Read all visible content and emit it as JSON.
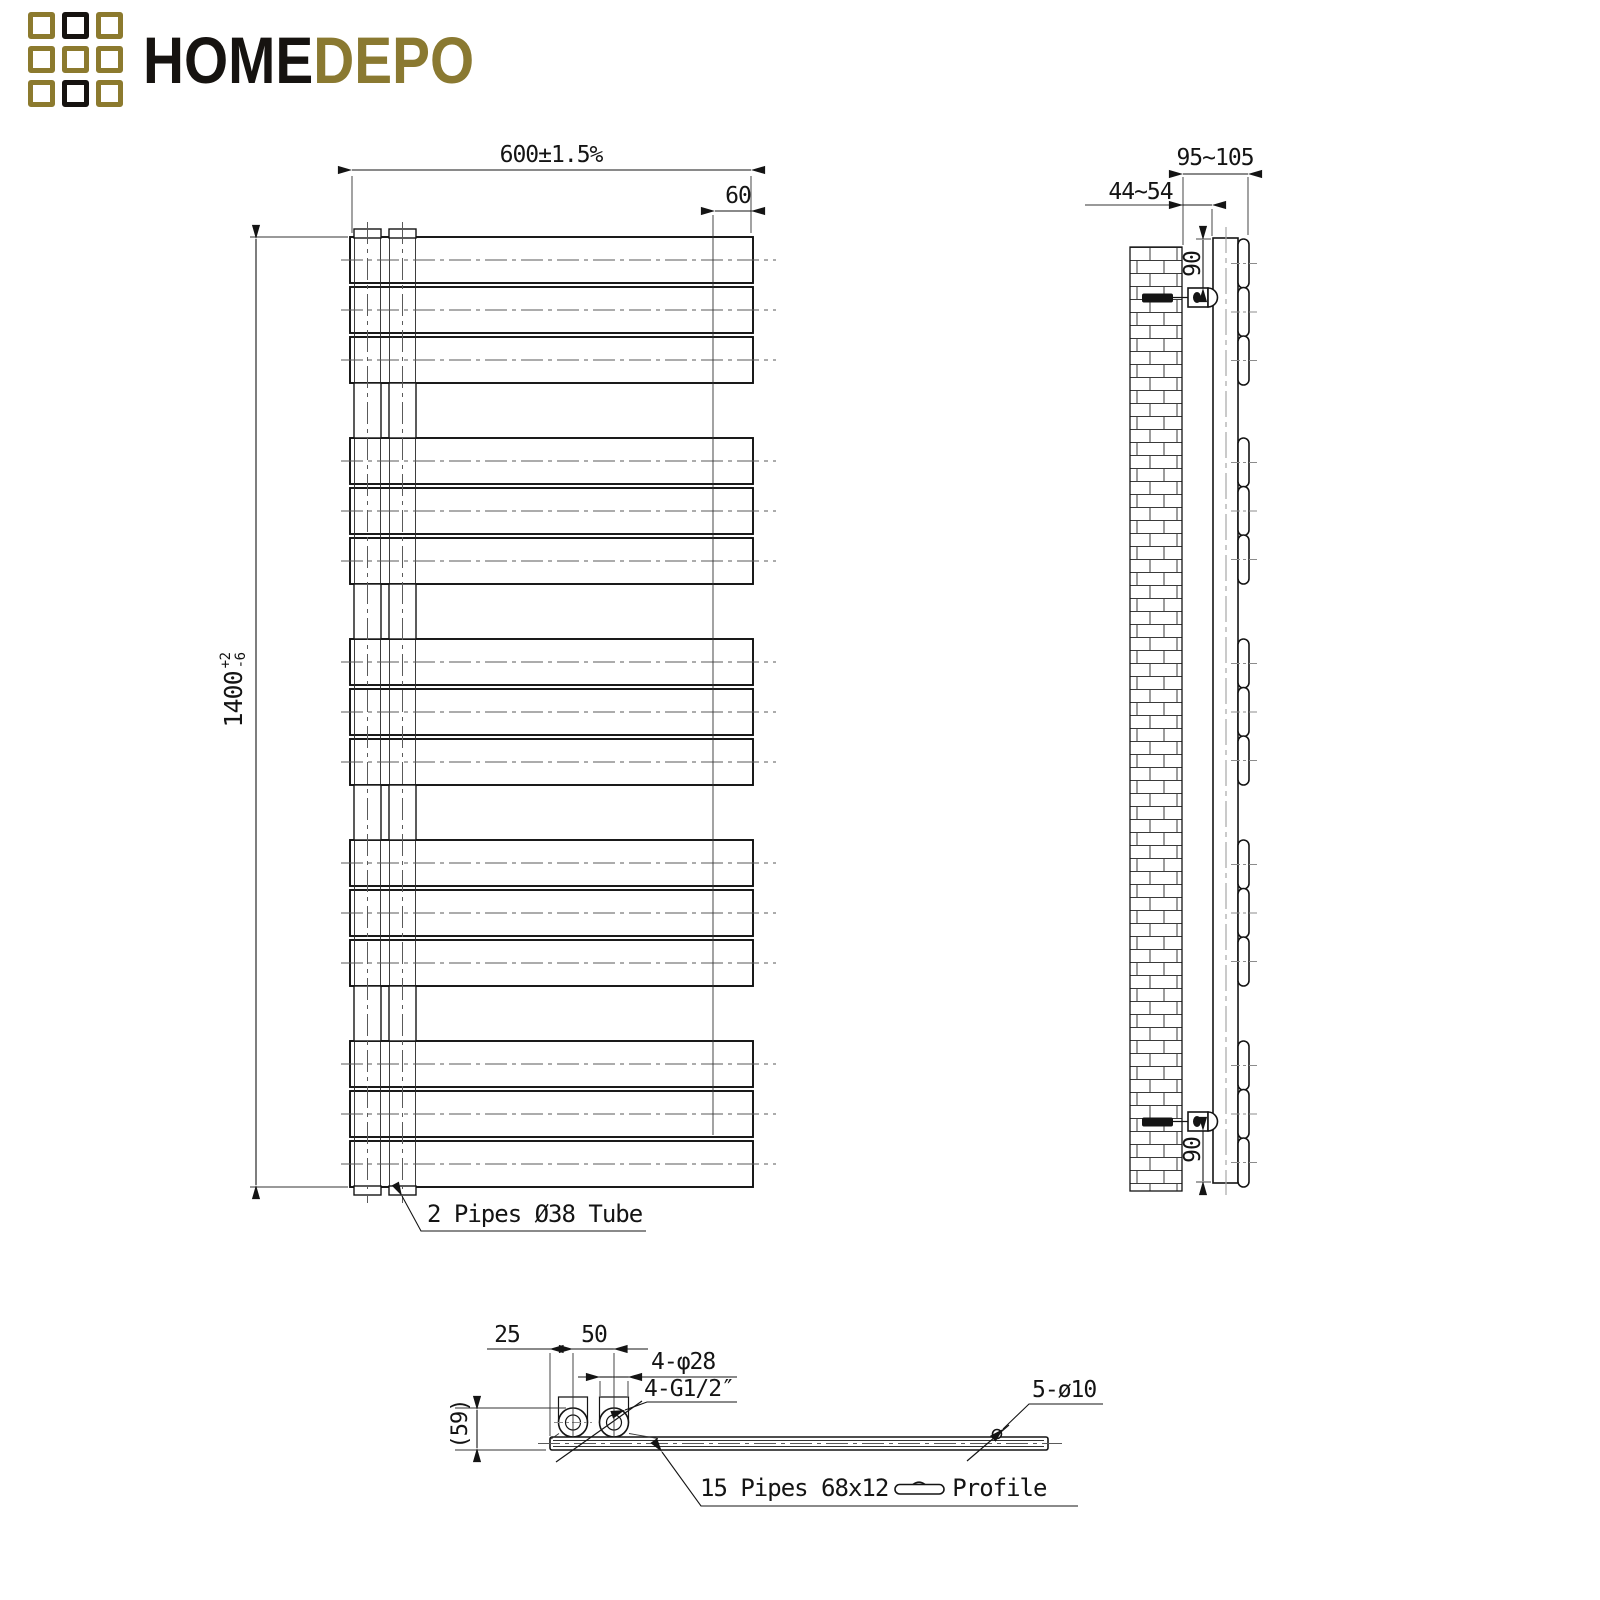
{
  "logo": {
    "brand_black": "HOME",
    "brand_gold": "DEPO",
    "colors": {
      "gold": "#8c7a2e",
      "black": "#161310"
    },
    "grid_pattern": [
      [
        "gold",
        "black",
        "gold"
      ],
      [
        "gold",
        "gold",
        "gold"
      ],
      [
        "gold",
        "black",
        "gold"
      ]
    ]
  },
  "front_view": {
    "dim_width": "600±1.5%",
    "dim_right_offset": "60",
    "dim_height": {
      "value": "1400",
      "tol_plus": "+2",
      "tol_minus": "-6"
    },
    "label_pipes": "2 Pipes Ø38 Tube",
    "bar_count": 15,
    "bar_groups": 5
  },
  "side_view": {
    "dim_total_depth": "95~105",
    "dim_wall_gap": "44~54",
    "dim_bracket_top": "90",
    "dim_bracket_bottom": "90"
  },
  "bottom_view": {
    "dim_edge_to_pipe": "25",
    "dim_pipe_spacing": "50",
    "dim_bosses": "4-φ28",
    "dim_threads": "4-G1/2″",
    "dim_height_ref": "(59)",
    "dim_small_holes": "5-ø10",
    "label_profile_pre": "15 Pipes 68x12",
    "label_profile_post": "Profile"
  }
}
